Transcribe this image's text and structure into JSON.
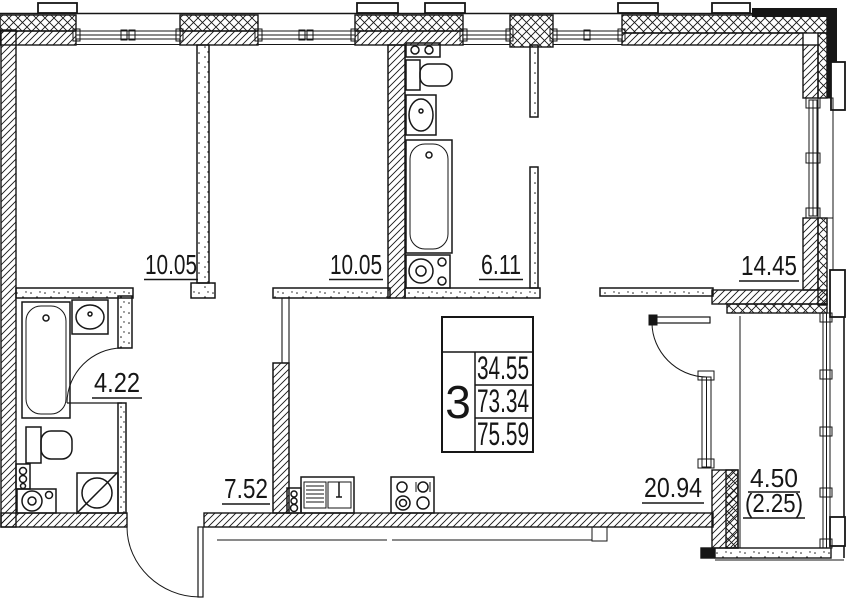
{
  "title": "apartment-floor-plan",
  "colors": {
    "line": "#161616",
    "background": "#ffffff"
  },
  "rooms": {
    "bedroom_1": {
      "label": "10.05"
    },
    "bedroom_2": {
      "label": "10.05"
    },
    "bathroom_ensuite": {
      "label": "6.11"
    },
    "bedroom_3": {
      "label": "14.45"
    },
    "bathroom": {
      "label": "4.22"
    },
    "hallway": {
      "label": "7.52"
    },
    "living_kitchen": {
      "label": "20.94"
    },
    "balcony": {
      "label": "4.50",
      "label_secondary": "(2.25)"
    }
  },
  "stamp": {
    "room_count": "3",
    "values": {
      "top": "34.55",
      "middle": "73.34",
      "bottom": "75.59"
    }
  },
  "fixtures": [
    "bathtub",
    "toilet",
    "sink",
    "washing-machine",
    "towel-rail",
    "ventilation-fan",
    "kitchen-sink",
    "stove",
    "door-swing",
    "window",
    "radiator"
  ]
}
